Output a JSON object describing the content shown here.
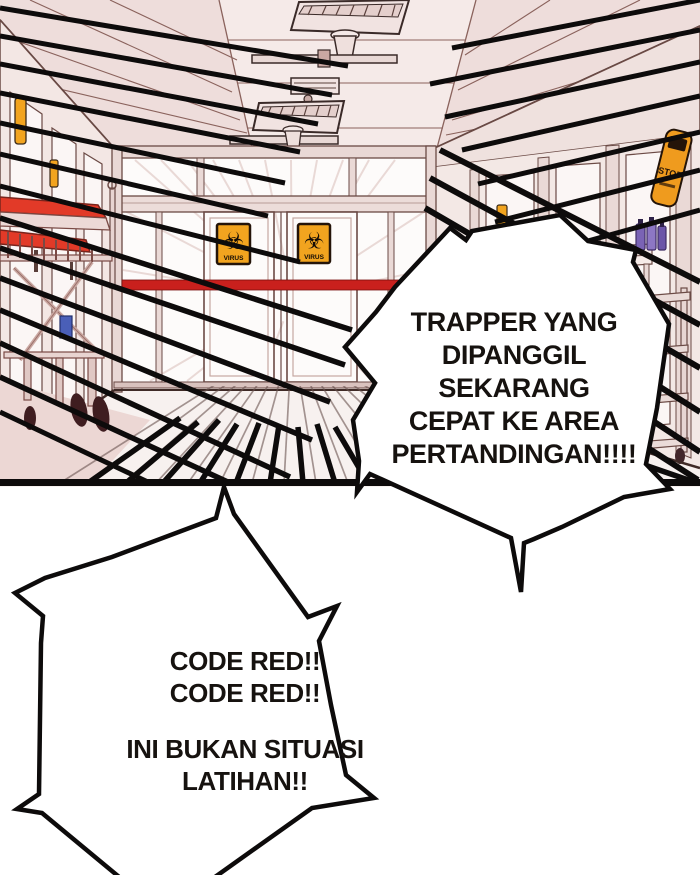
{
  "panel": {
    "scene": "hospital corridor with sliding glass doors, gurney and action speed lines",
    "signs": {
      "virus_left": "VIRUS",
      "virus_right": "VIRUS",
      "stop": "STOP",
      "biohazard_glyph": "☣"
    },
    "colors": {
      "wall_pink": "#efe0dd",
      "ceiling_pink": "#eedddb",
      "accent_red": "#c9201d",
      "mattress_red": "#e23a28",
      "sign_orange": "#f2a41f",
      "line_black": "#0d0b0b",
      "bottle_purple": "#7a63b5"
    }
  },
  "bubbles": {
    "announcement": {
      "lines": [
        "TRAPPER YANG",
        "DIPANGGIL SEKARANG",
        "CEPAT KE AREA",
        "PERTANDINGAN!!!!"
      ]
    },
    "alarm": {
      "lines": [
        "CODE RED!!",
        "CODE RED!!",
        "INI BUKAN SITUASI",
        "LATIHAN!!"
      ]
    }
  }
}
